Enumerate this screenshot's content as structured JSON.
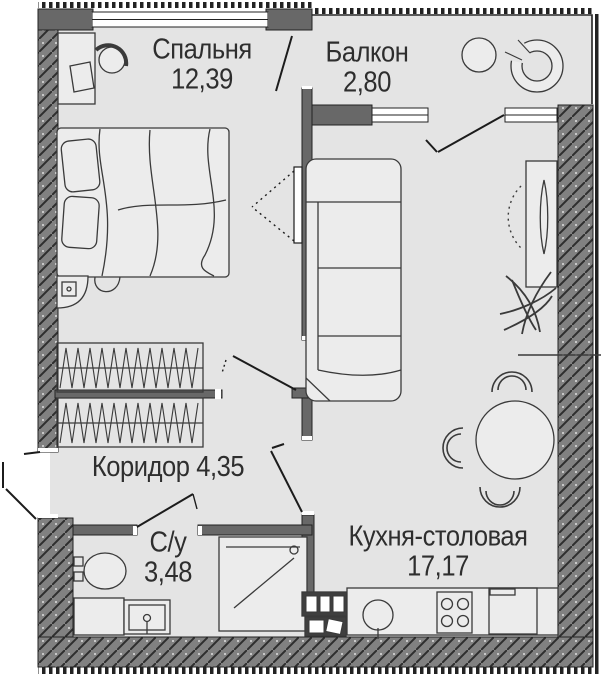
{
  "plan": {
    "rooms": [
      {
        "id": "bedroom",
        "name": "Спальня",
        "area": "12,39"
      },
      {
        "id": "balcony",
        "name": "Балкон",
        "area": "2,80"
      },
      {
        "id": "corridor",
        "name": "Коридор",
        "area": "4,35"
      },
      {
        "id": "bathroom",
        "name": "С/у",
        "area": "3,48"
      },
      {
        "id": "kitchen",
        "name": "Кухня-столовая",
        "area": "17,17"
      }
    ],
    "colors": {
      "floor": "#e4e4e4",
      "wall_solid": "#686868",
      "wall_hatch_bg": "#818181",
      "outline": "#2a2a2a",
      "furniture_fill": "#ececec",
      "label_text": "#2e2e2e"
    }
  }
}
